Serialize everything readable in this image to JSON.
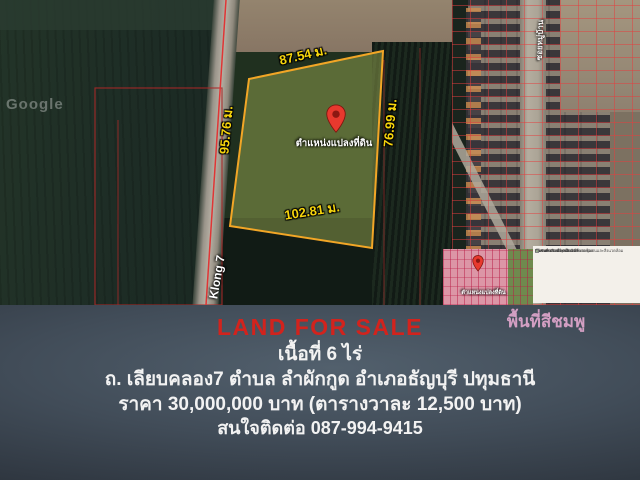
{
  "flyer": {
    "title": "LAND FOR SALE",
    "title_color": "#d2231d",
    "area_line": "เนื้อที่ 6 ไร่",
    "address_line": "ถ. เลียบคลอง7 ตำบล ลำผักกูด อำเภอธัญบุรี ปทุมธานี",
    "price_line": "ราคา 30,000,000 บาท (ตารางวาละ 12,500 บาท)",
    "contact_line": "สนใจติดต่อ 087-994-9415"
  },
  "map": {
    "watermark": "Google",
    "road_label": "Klong 7",
    "soi_label": "ซอยหมู่บ้าน",
    "pin_label": "ตำแหน่งแปลงที่ดิน",
    "pin_color": "#e8392e",
    "plot_outline_color": "#f2a626",
    "measurements": {
      "top": "87.54 ม.",
      "right": "76.99 ม.",
      "bottom": "102.81 ม.",
      "left": "95.76 ม."
    }
  },
  "inset": {
    "pin_label": "ตำแหน่งแปลงที่ดิน",
    "caption": "พื้นที่สีชมพู",
    "caption_color": "#d39fc3",
    "legend": [
      {
        "color": "#d6418c",
        "label": "ชุมชนพาณิชยกรรม"
      },
      {
        "color": "#d6418c",
        "label": "อุตสาหกรรมและบริการ"
      },
      {
        "color": "#8a3a6a",
        "label": "อุตสาหกรรมที่ไม่เป็นมลพิษต่อชุมชนและสิ่งแวดล้อม"
      },
      {
        "color": "#323264",
        "label": "อุตสาหกรรมและคลังสินค้า"
      },
      {
        "color": "#e87fae",
        "label": "ชุมชน"
      },
      {
        "color": "#e87fae",
        "label": "ชุมชน ห1"
      },
      {
        "color": "#e87fae",
        "label": "ชุมชน ห2"
      },
      {
        "color": "#b8cfa0",
        "label": "ที่โล่งเพื่อรักษาคุณภาพสิ่งแวดล้อม"
      }
    ]
  }
}
